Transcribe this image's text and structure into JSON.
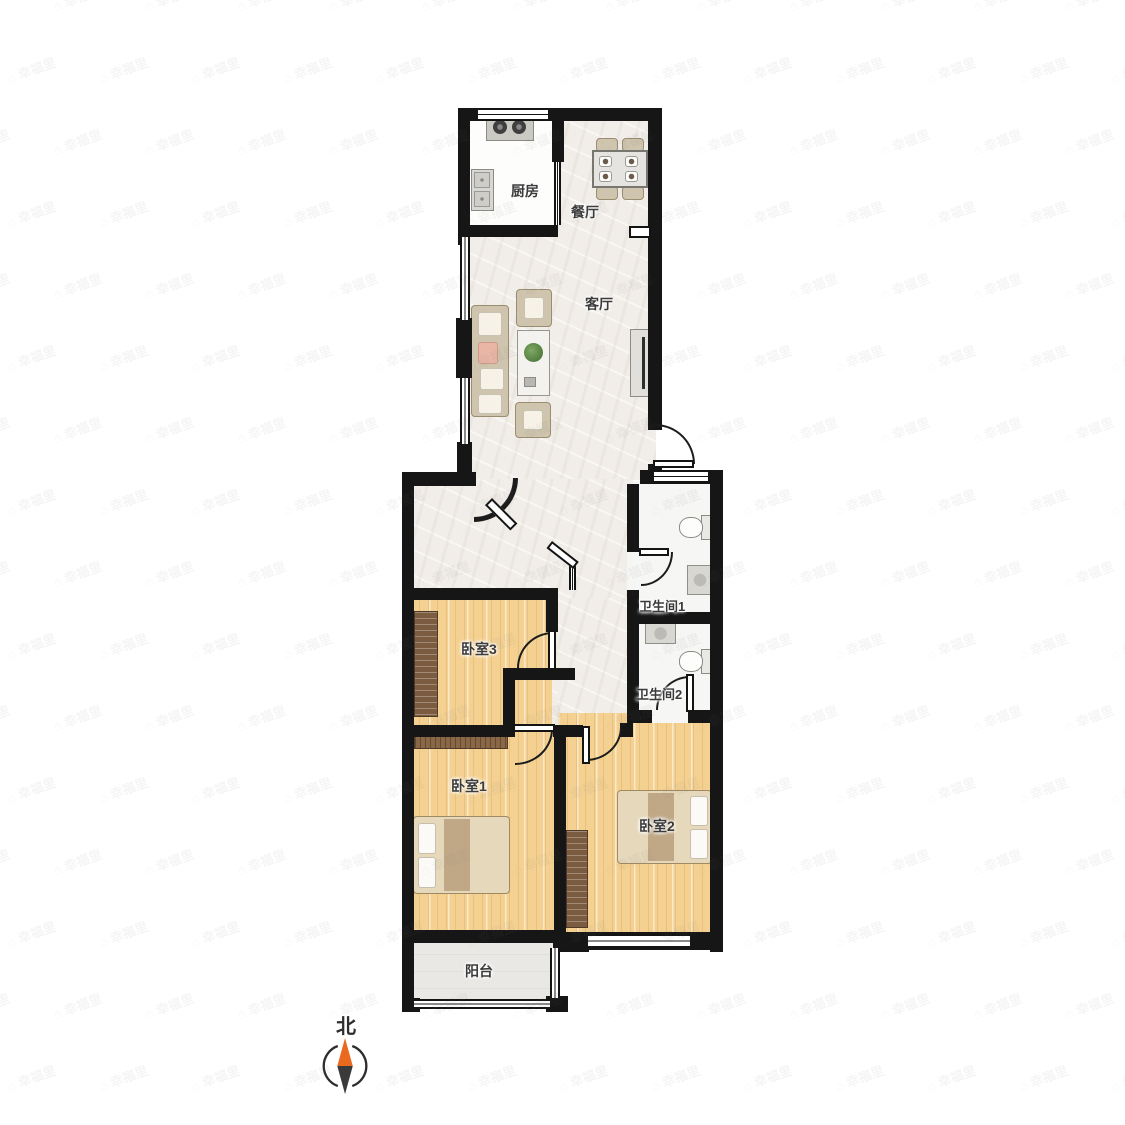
{
  "watermark": {
    "icon": "⌂",
    "text": "幸福里"
  },
  "compass": {
    "north_label": "北"
  },
  "rooms": {
    "kitchen": "厨房",
    "dining": "餐厅",
    "living": "客厅",
    "bath1": "卫生间1",
    "bath2": "卫生间2",
    "bed3": "卧室3",
    "bed1": "卧室1",
    "bed2": "卧室2",
    "balcony": "阳台"
  },
  "colors": {
    "wall": "#161616",
    "wood_floor": "#f4d191",
    "marble_floor": "#f1ede8",
    "bath_floor": "#f6f6f4",
    "balcony_floor": "#e9e8e5",
    "furniture_tan": "#cfc4ad",
    "wardrobe_brown": "#7c5c40",
    "compass_north_orange": "#e96a1f",
    "compass_south_gray": "#3a3a3a",
    "label_text": "#3b3b3b"
  }
}
